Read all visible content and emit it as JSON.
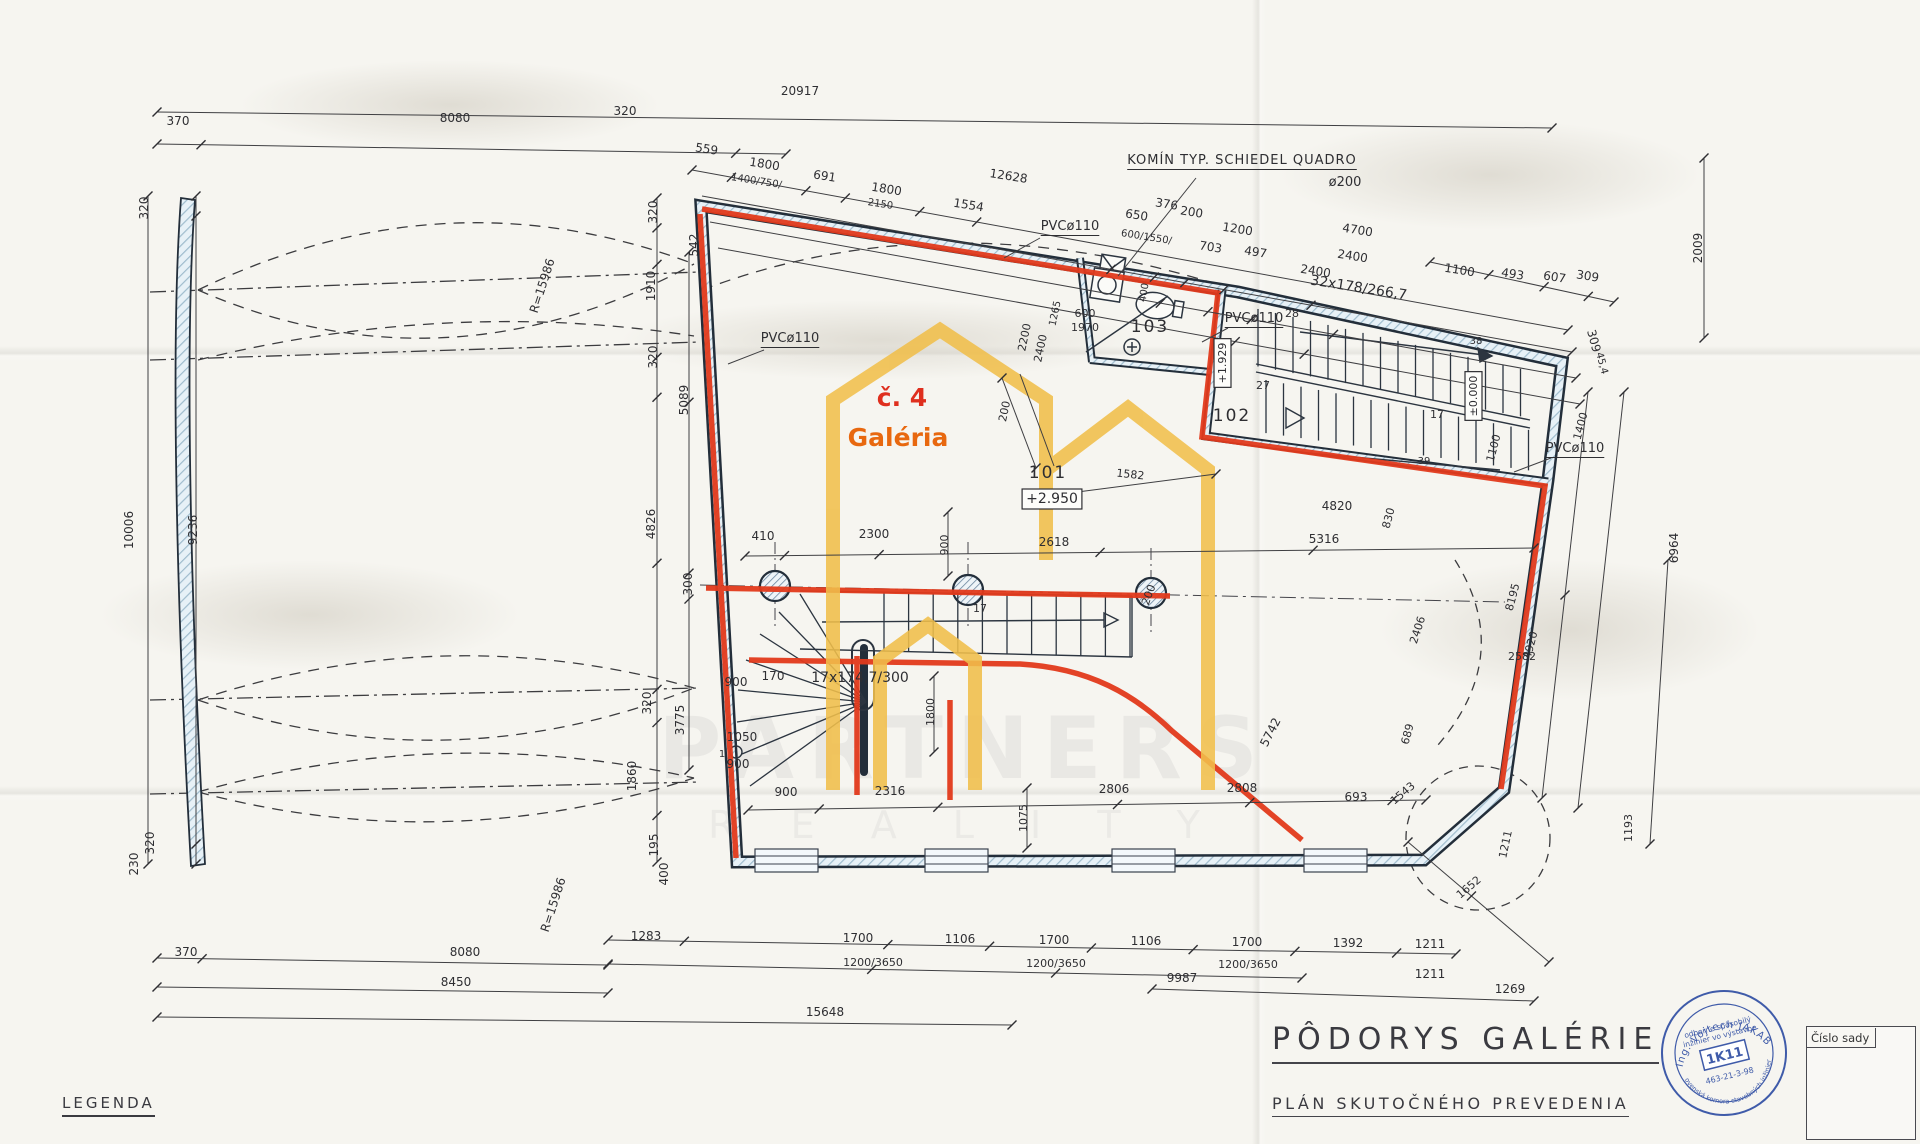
{
  "title_block": {
    "title": "PÔDORYS GALÉRIE",
    "subtitle": "PLÁN SKUTOČNÉHO PREVEDENIA"
  },
  "legend_label": "LEGENDA",
  "set_box": {
    "label": "Číslo sady"
  },
  "stamp": {
    "arc_top": "Ing. Vojtech JAKAB",
    "line1": "odborne spôsobilý",
    "line2": "inžinier vo výstavbe",
    "code": "1K11",
    "number": "463-21-3-98",
    "arc_bottom": "Slovenská komora stavebných inžinierov"
  },
  "unit_label": {
    "number": "č. 4",
    "name": "Galéria"
  },
  "rooms": [
    {
      "id": "101",
      "elevation": "+2.950"
    },
    {
      "id": "102"
    },
    {
      "id": "103"
    }
  ],
  "annotations": {
    "chimney": "KOMÍN TYP. SCHIEDEL QUADRO",
    "chimney_diameter": "ø200",
    "pipe": "PVCø110",
    "stair_upper": "32x178/266,7",
    "stair_lower": "17x174,7/300"
  },
  "watermark": {
    "line1": "PARTNERS",
    "line2": "R E A L I T Y"
  },
  "colors": {
    "red": "#e23a1c",
    "yellow": "#f1bf4b",
    "wall_core": "#d9e9f2",
    "ink": "#2e2e32",
    "stamp_blue": "#3f5ba9"
  },
  "labels": [
    {
      "t": "20917",
      "x": 800,
      "y": 95,
      "n": "overall-width-dim"
    },
    {
      "t": "370",
      "x": 178,
      "y": 125
    },
    {
      "t": "8080",
      "x": 455,
      "y": 122
    },
    {
      "t": "320",
      "x": 625,
      "y": 115
    },
    {
      "t": "559",
      "x": 706,
      "y": 153,
      "r": 9
    },
    {
      "t": "1800",
      "x": 764,
      "y": 168,
      "r": 9
    },
    {
      "t": "1400/750/",
      "x": 756,
      "y": 184,
      "r": 9,
      "s": 10
    },
    {
      "t": "691",
      "x": 824,
      "y": 180,
      "r": 9
    },
    {
      "t": "1800",
      "x": 886,
      "y": 193,
      "r": 9
    },
    {
      "t": "2150",
      "x": 880,
      "y": 207,
      "r": 9,
      "s": 10
    },
    {
      "t": "1554",
      "x": 968,
      "y": 209,
      "r": 9
    },
    {
      "t": "12628",
      "x": 1008,
      "y": 180,
      "r": 9
    },
    {
      "t": "KOMÍN TYP. SCHIEDEL QUADRO",
      "x": 1242,
      "y": 164,
      "s": 13,
      "u": 1,
      "ls": 1,
      "n": "chimney-annotation"
    },
    {
      "t": "ø200",
      "x": 1345,
      "y": 186,
      "s": 13
    },
    {
      "t": "650",
      "x": 1136,
      "y": 219,
      "r": 9
    },
    {
      "t": "376",
      "x": 1166,
      "y": 208,
      "r": 9
    },
    {
      "t": "200",
      "x": 1191,
      "y": 216,
      "r": 9
    },
    {
      "t": "600/1550/",
      "x": 1146,
      "y": 240,
      "r": 9,
      "s": 10
    },
    {
      "t": "1200",
      "x": 1237,
      "y": 233,
      "r": 9
    },
    {
      "t": "703",
      "x": 1210,
      "y": 251,
      "r": 9
    },
    {
      "t": "497",
      "x": 1255,
      "y": 256,
      "r": 9
    },
    {
      "t": "4700",
      "x": 1357,
      "y": 234,
      "r": 9
    },
    {
      "t": "2400",
      "x": 1352,
      "y": 260,
      "r": 9
    },
    {
      "t": "2400",
      "x": 1315,
      "y": 275,
      "r": 9
    },
    {
      "t": "32x178/266,7",
      "x": 1358,
      "y": 292,
      "r": 9,
      "s": 14,
      "n": "stair-upper-annotation"
    },
    {
      "t": "1100",
      "x": 1459,
      "y": 274,
      "r": 9
    },
    {
      "t": "493",
      "x": 1512,
      "y": 278,
      "r": 9
    },
    {
      "t": "607",
      "x": 1554,
      "y": 281,
      "r": 9
    },
    {
      "t": "309",
      "x": 1587,
      "y": 280,
      "r": 9
    },
    {
      "t": "2009",
      "x": 1702,
      "y": 248,
      "r": -90
    },
    {
      "t": "309",
      "x": 1590,
      "y": 342,
      "r": 75
    },
    {
      "t": "45,4",
      "x": 1599,
      "y": 364,
      "r": 75,
      "s": 10
    },
    {
      "t": "PVCø110",
      "x": 1070,
      "y": 230,
      "s": 13,
      "u": 1,
      "n": "pipe-annotation"
    },
    {
      "t": "PVCø110",
      "x": 790,
      "y": 342,
      "s": 13,
      "u": 1,
      "n": "pipe-annotation"
    },
    {
      "t": "PVCø110",
      "x": 1254,
      "y": 322,
      "s": 13,
      "u": 1,
      "n": "pipe-annotation"
    },
    {
      "t": "PVCø110",
      "x": 1575,
      "y": 452,
      "s": 13,
      "u": 1,
      "n": "pipe-annotation"
    },
    {
      "t": "103",
      "x": 1150,
      "y": 332,
      "s": 17,
      "ls": 2,
      "n": "room-number-103"
    },
    {
      "t": "102",
      "x": 1232,
      "y": 421,
      "s": 17,
      "ls": 2,
      "n": "room-number-102"
    },
    {
      "t": "101",
      "x": 1048,
      "y": 478,
      "s": 17,
      "ls": 2,
      "n": "room-number-101"
    },
    {
      "t": "+2.950",
      "x": 1052,
      "y": 503,
      "s": 14,
      "b": 1,
      "n": "elevation-marker"
    },
    {
      "t": "+1.929",
      "x": 1226,
      "y": 363,
      "r": -90,
      "s": 11,
      "b": 1,
      "n": "elevation-marker"
    },
    {
      "t": "±0.000",
      "x": 1477,
      "y": 396,
      "r": -90,
      "s": 11,
      "b": 1,
      "n": "elevation-marker"
    },
    {
      "t": "č. 4",
      "x": 902,
      "y": 406,
      "s": 25,
      "c": "#df2f1e",
      "w": 1,
      "n": "unit-number"
    },
    {
      "t": "Galéria",
      "x": 898,
      "y": 446,
      "s": 25,
      "c": "#e8680f",
      "w": 1,
      "n": "unit-name"
    },
    {
      "t": "28",
      "x": 1292,
      "y": 317,
      "s": 11
    },
    {
      "t": "27",
      "x": 1263,
      "y": 389,
      "s": 11
    },
    {
      "t": "38",
      "x": 1476,
      "y": 344,
      "s": 10
    },
    {
      "t": "39",
      "x": 1424,
      "y": 464,
      "s": 10
    },
    {
      "t": "17",
      "x": 1437,
      "y": 418,
      "s": 11
    },
    {
      "t": "17",
      "x": 980,
      "y": 612,
      "s": 11
    },
    {
      "t": "1",
      "x": 722,
      "y": 757,
      "s": 10
    },
    {
      "t": "1265",
      "x": 1058,
      "y": 314,
      "r": -78,
      "s": 10
    },
    {
      "t": "600",
      "x": 1085,
      "y": 317,
      "s": 11
    },
    {
      "t": "1970",
      "x": 1085,
      "y": 331,
      "s": 11
    },
    {
      "t": "2200",
      "x": 1028,
      "y": 338,
      "r": -78,
      "s": 11
    },
    {
      "t": "2400",
      "x": 1044,
      "y": 349,
      "r": -78,
      "s": 11
    },
    {
      "t": "400",
      "x": 1147,
      "y": 293,
      "r": -80,
      "s": 10
    },
    {
      "t": "320",
      "x": 148,
      "y": 208,
      "r": -90
    },
    {
      "t": "10006",
      "x": 133,
      "y": 530,
      "r": -90
    },
    {
      "t": "9236",
      "x": 197,
      "y": 530,
      "r": -90
    },
    {
      "t": "320",
      "x": 154,
      "y": 843,
      "r": -90
    },
    {
      "t": "230",
      "x": 138,
      "y": 864,
      "r": -90
    },
    {
      "t": "R=15986",
      "x": 546,
      "y": 287,
      "r": -72
    },
    {
      "t": "R=15986",
      "x": 557,
      "y": 906,
      "r": -72
    },
    {
      "t": "320",
      "x": 657,
      "y": 212,
      "r": -90
    },
    {
      "t": "542",
      "x": 698,
      "y": 245,
      "r": -90
    },
    {
      "t": "1910",
      "x": 655,
      "y": 286,
      "r": -90
    },
    {
      "t": "320",
      "x": 657,
      "y": 357,
      "r": -90
    },
    {
      "t": "5089",
      "x": 688,
      "y": 400,
      "r": -90
    },
    {
      "t": "4826",
      "x": 655,
      "y": 524,
      "r": -90
    },
    {
      "t": "300",
      "x": 692,
      "y": 584,
      "r": -90
    },
    {
      "t": "320",
      "x": 651,
      "y": 703,
      "r": -90
    },
    {
      "t": "3775",
      "x": 684,
      "y": 720,
      "r": -90
    },
    {
      "t": "1860",
      "x": 636,
      "y": 776,
      "r": -90
    },
    {
      "t": "195",
      "x": 658,
      "y": 845,
      "r": -90
    },
    {
      "t": "400",
      "x": 668,
      "y": 874,
      "r": -90
    },
    {
      "t": "410",
      "x": 763,
      "y": 540
    },
    {
      "t": "2300",
      "x": 874,
      "y": 538
    },
    {
      "t": "2618",
      "x": 1054,
      "y": 546
    },
    {
      "t": "5316",
      "x": 1324,
      "y": 543
    },
    {
      "t": "4820",
      "x": 1337,
      "y": 510
    },
    {
      "t": "1582",
      "x": 1130,
      "y": 478,
      "s": 11,
      "r": 6
    },
    {
      "t": "200",
      "x": 1008,
      "y": 412,
      "r": -78,
      "s": 11
    },
    {
      "t": "830",
      "x": 1392,
      "y": 519,
      "r": -75,
      "s": 11
    },
    {
      "t": "200",
      "x": 1152,
      "y": 596,
      "r": -70,
      "s": 11
    },
    {
      "t": "900",
      "x": 948,
      "y": 545,
      "r": -90,
      "s": 11
    },
    {
      "t": "17x174,7/300",
      "x": 860,
      "y": 682,
      "s": 14,
      "n": "stair-lower-annotation"
    },
    {
      "t": "170",
      "x": 773,
      "y": 680,
      "s": 12
    },
    {
      "t": "900",
      "x": 736,
      "y": 686,
      "s": 12
    },
    {
      "t": "1050",
      "x": 742,
      "y": 741,
      "s": 12
    },
    {
      "t": "900",
      "x": 738,
      "y": 768,
      "s": 12
    },
    {
      "t": "1800",
      "x": 934,
      "y": 712,
      "r": -90,
      "s": 11
    },
    {
      "t": "1075",
      "x": 1027,
      "y": 818,
      "r": -90,
      "s": 11
    },
    {
      "t": "5742",
      "x": 1274,
      "y": 734,
      "r": -63,
      "s": 12
    },
    {
      "t": "689",
      "x": 1411,
      "y": 735,
      "r": -75,
      "s": 11
    },
    {
      "t": "2406",
      "x": 1421,
      "y": 631,
      "r": -72,
      "s": 11
    },
    {
      "t": "2582",
      "x": 1522,
      "y": 660,
      "s": 11
    },
    {
      "t": "1400",
      "x": 1584,
      "y": 427,
      "r": -75,
      "s": 11
    },
    {
      "t": "1100",
      "x": 1497,
      "y": 449,
      "r": -75,
      "s": 11
    },
    {
      "t": "6964",
      "x": 1678,
      "y": 548,
      "r": -90
    },
    {
      "t": "8195",
      "x": 1516,
      "y": 598,
      "r": -75,
      "s": 11
    },
    {
      "t": "4920",
      "x": 1534,
      "y": 646,
      "r": -75,
      "s": 11
    },
    {
      "t": "900",
      "x": 786,
      "y": 796
    },
    {
      "t": "2316",
      "x": 890,
      "y": 795
    },
    {
      "t": "2806",
      "x": 1114,
      "y": 793
    },
    {
      "t": "2808",
      "x": 1242,
      "y": 792
    },
    {
      "t": "693",
      "x": 1356,
      "y": 801
    },
    {
      "t": "1543",
      "x": 1405,
      "y": 796,
      "r": -40,
      "s": 11
    },
    {
      "t": "1211",
      "x": 1509,
      "y": 845,
      "r": -78,
      "s": 11
    },
    {
      "t": "1193",
      "x": 1632,
      "y": 828,
      "r": -90,
      "s": 11
    },
    {
      "t": "1652",
      "x": 1471,
      "y": 890,
      "r": -40,
      "s": 11
    },
    {
      "t": "1283",
      "x": 646,
      "y": 940
    },
    {
      "t": "1700",
      "x": 858,
      "y": 942
    },
    {
      "t": "1106",
      "x": 960,
      "y": 943
    },
    {
      "t": "1700",
      "x": 1054,
      "y": 944
    },
    {
      "t": "1106",
      "x": 1146,
      "y": 945
    },
    {
      "t": "1700",
      "x": 1247,
      "y": 946
    },
    {
      "t": "1392",
      "x": 1348,
      "y": 947
    },
    {
      "t": "1211",
      "x": 1430,
      "y": 948
    },
    {
      "t": "1200/3650",
      "x": 873,
      "y": 966,
      "s": 11
    },
    {
      "t": "1200/3650",
      "x": 1056,
      "y": 967,
      "s": 11
    },
    {
      "t": "1200/3650",
      "x": 1248,
      "y": 968,
      "s": 11
    },
    {
      "t": "9987",
      "x": 1182,
      "y": 982
    },
    {
      "t": "370",
      "x": 186,
      "y": 956
    },
    {
      "t": "8080",
      "x": 465,
      "y": 956
    },
    {
      "t": "8450",
      "x": 456,
      "y": 986
    },
    {
      "t": "1211",
      "x": 1430,
      "y": 978
    },
    {
      "t": "15648",
      "x": 825,
      "y": 1016
    },
    {
      "t": "1269",
      "x": 1510,
      "y": 993
    }
  ]
}
